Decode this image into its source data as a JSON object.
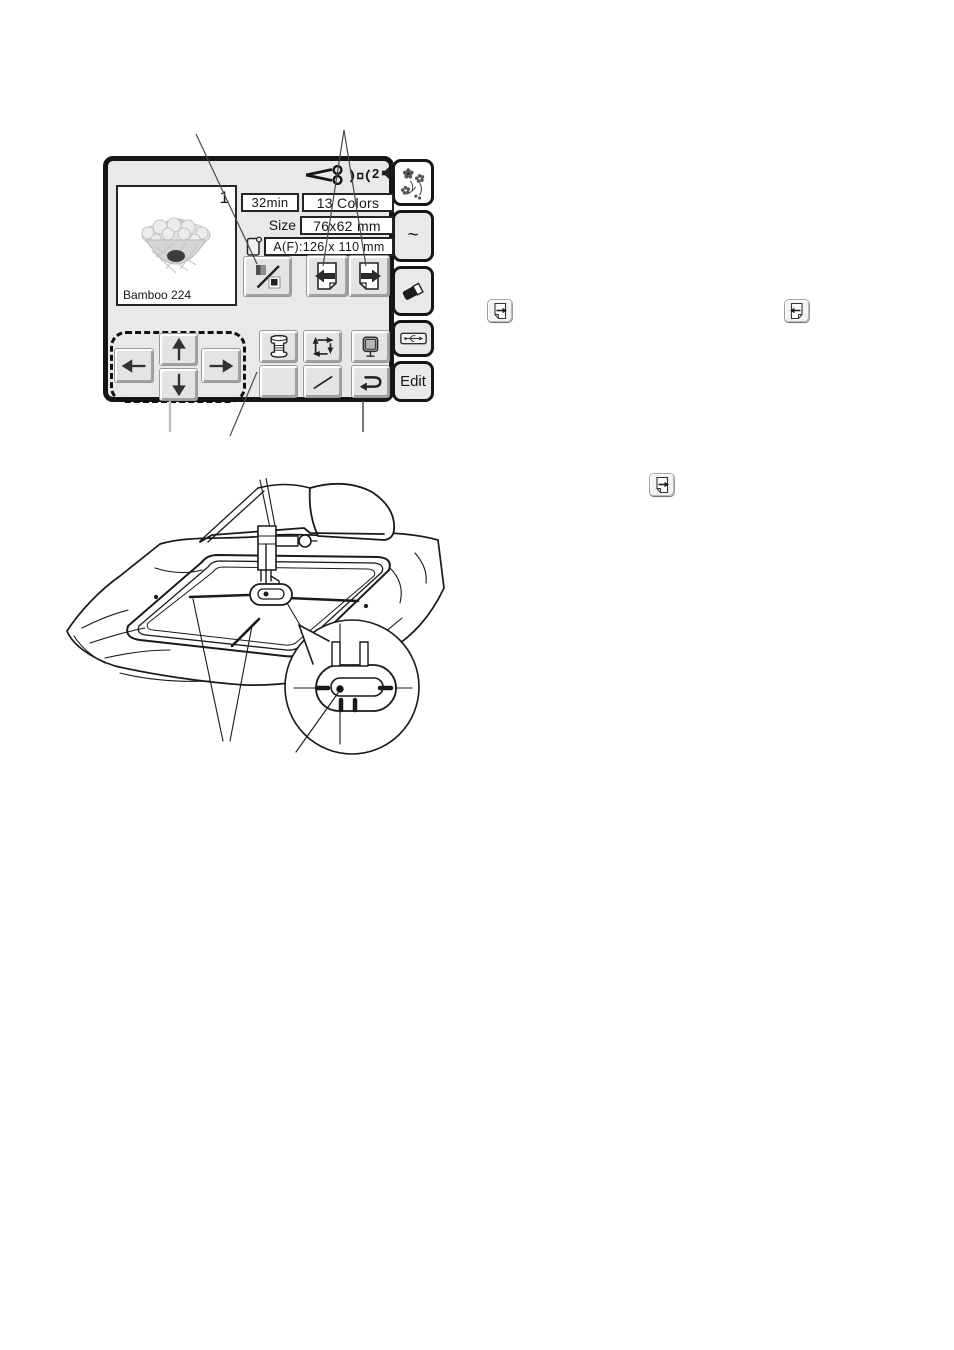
{
  "lcd": {
    "status": {
      "volume_level": "2"
    },
    "preview": {
      "index": "1",
      "design_name": "Bamboo 224"
    },
    "fields": {
      "time": "32min",
      "colors": "13 Colors",
      "size_label": "Size",
      "size_value": "76x62 mm",
      "hoop_value": "A(F):126 x 110 mm"
    },
    "tabs": {
      "tilde": "~",
      "edit": "Edit"
    }
  },
  "icons": {
    "scissors-icon": "auto-thread-cut",
    "needle-plate-icon": "presser-indicator",
    "speaker-icon": "sound",
    "design-tab-icon": "flower-bouquet-design",
    "eraser-icon": "erase",
    "usb-icon": "usb-connection",
    "hoop-tag-icon": "hoop-size-tag",
    "color-section-icon": "color-section-skip",
    "page-back-icon": "previous-page",
    "page-forward-icon": "next-page",
    "arrow-left-icon": "jog-left",
    "arrow-up-icon": "jog-up",
    "arrow-down-icon": "jog-down",
    "arrow-right-icon": "jog-right",
    "bobbin-icon": "bobbin-thread",
    "trace-icon": "trace-outline",
    "hoop-monitor-icon": "screen-adjust",
    "baste-line-icon": "stitch-line",
    "return-icon": "return"
  },
  "colors": {
    "frame": "#161616",
    "screen_bg": "#e9e9e9",
    "button_face": "#e4e4e4",
    "field_bg": "#ffffff",
    "icon_ink": "#222222",
    "callout": "#4a4a4a",
    "drawing_ink": "#1a1a1a"
  }
}
